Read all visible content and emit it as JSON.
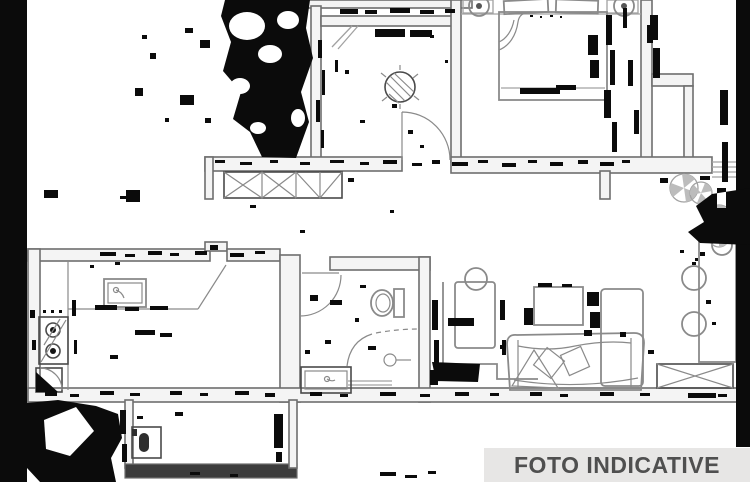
{
  "badge": {
    "label": "FOTO INDICATIVE"
  },
  "colors": {
    "background": "#ffffff",
    "line": "#6e6e6e",
    "furniture": "#8a8a8a",
    "furniture_light": "#a2a2a2",
    "wall_fill": "#f4f4f4",
    "wall_dark": "#3c3c3c",
    "noise": "#0b0b0b",
    "plant_fill": "#bcbcbc",
    "badge_bg": "#e7e6e5",
    "badge_text": "#4f4f4f"
  },
  "plan": {
    "type": "apartment-floor-plan-scan",
    "rooms": [
      "bedroom",
      "hallway",
      "corridor",
      "bathroom",
      "kitchen",
      "living-room",
      "terrace",
      "laundry-balcony"
    ],
    "furniture": [
      "double-bed",
      "pillows",
      "bedside-lamps",
      "wardrobe-x",
      "potted-plant",
      "terrace-plants",
      "dining-table",
      "dining-chairs",
      "radiator-bench",
      "sofa",
      "coffee-table",
      "tall-cabinet",
      "desk",
      "desk-stool",
      "toilet",
      "shower",
      "bathroom-vanity",
      "kitchen-sink",
      "stove",
      "corner-unit",
      "washing-machine"
    ],
    "artifacts": [
      "left-black-bar",
      "right-black-bar",
      "scan-noise-blobs",
      "wall-hatch-dashes"
    ]
  }
}
